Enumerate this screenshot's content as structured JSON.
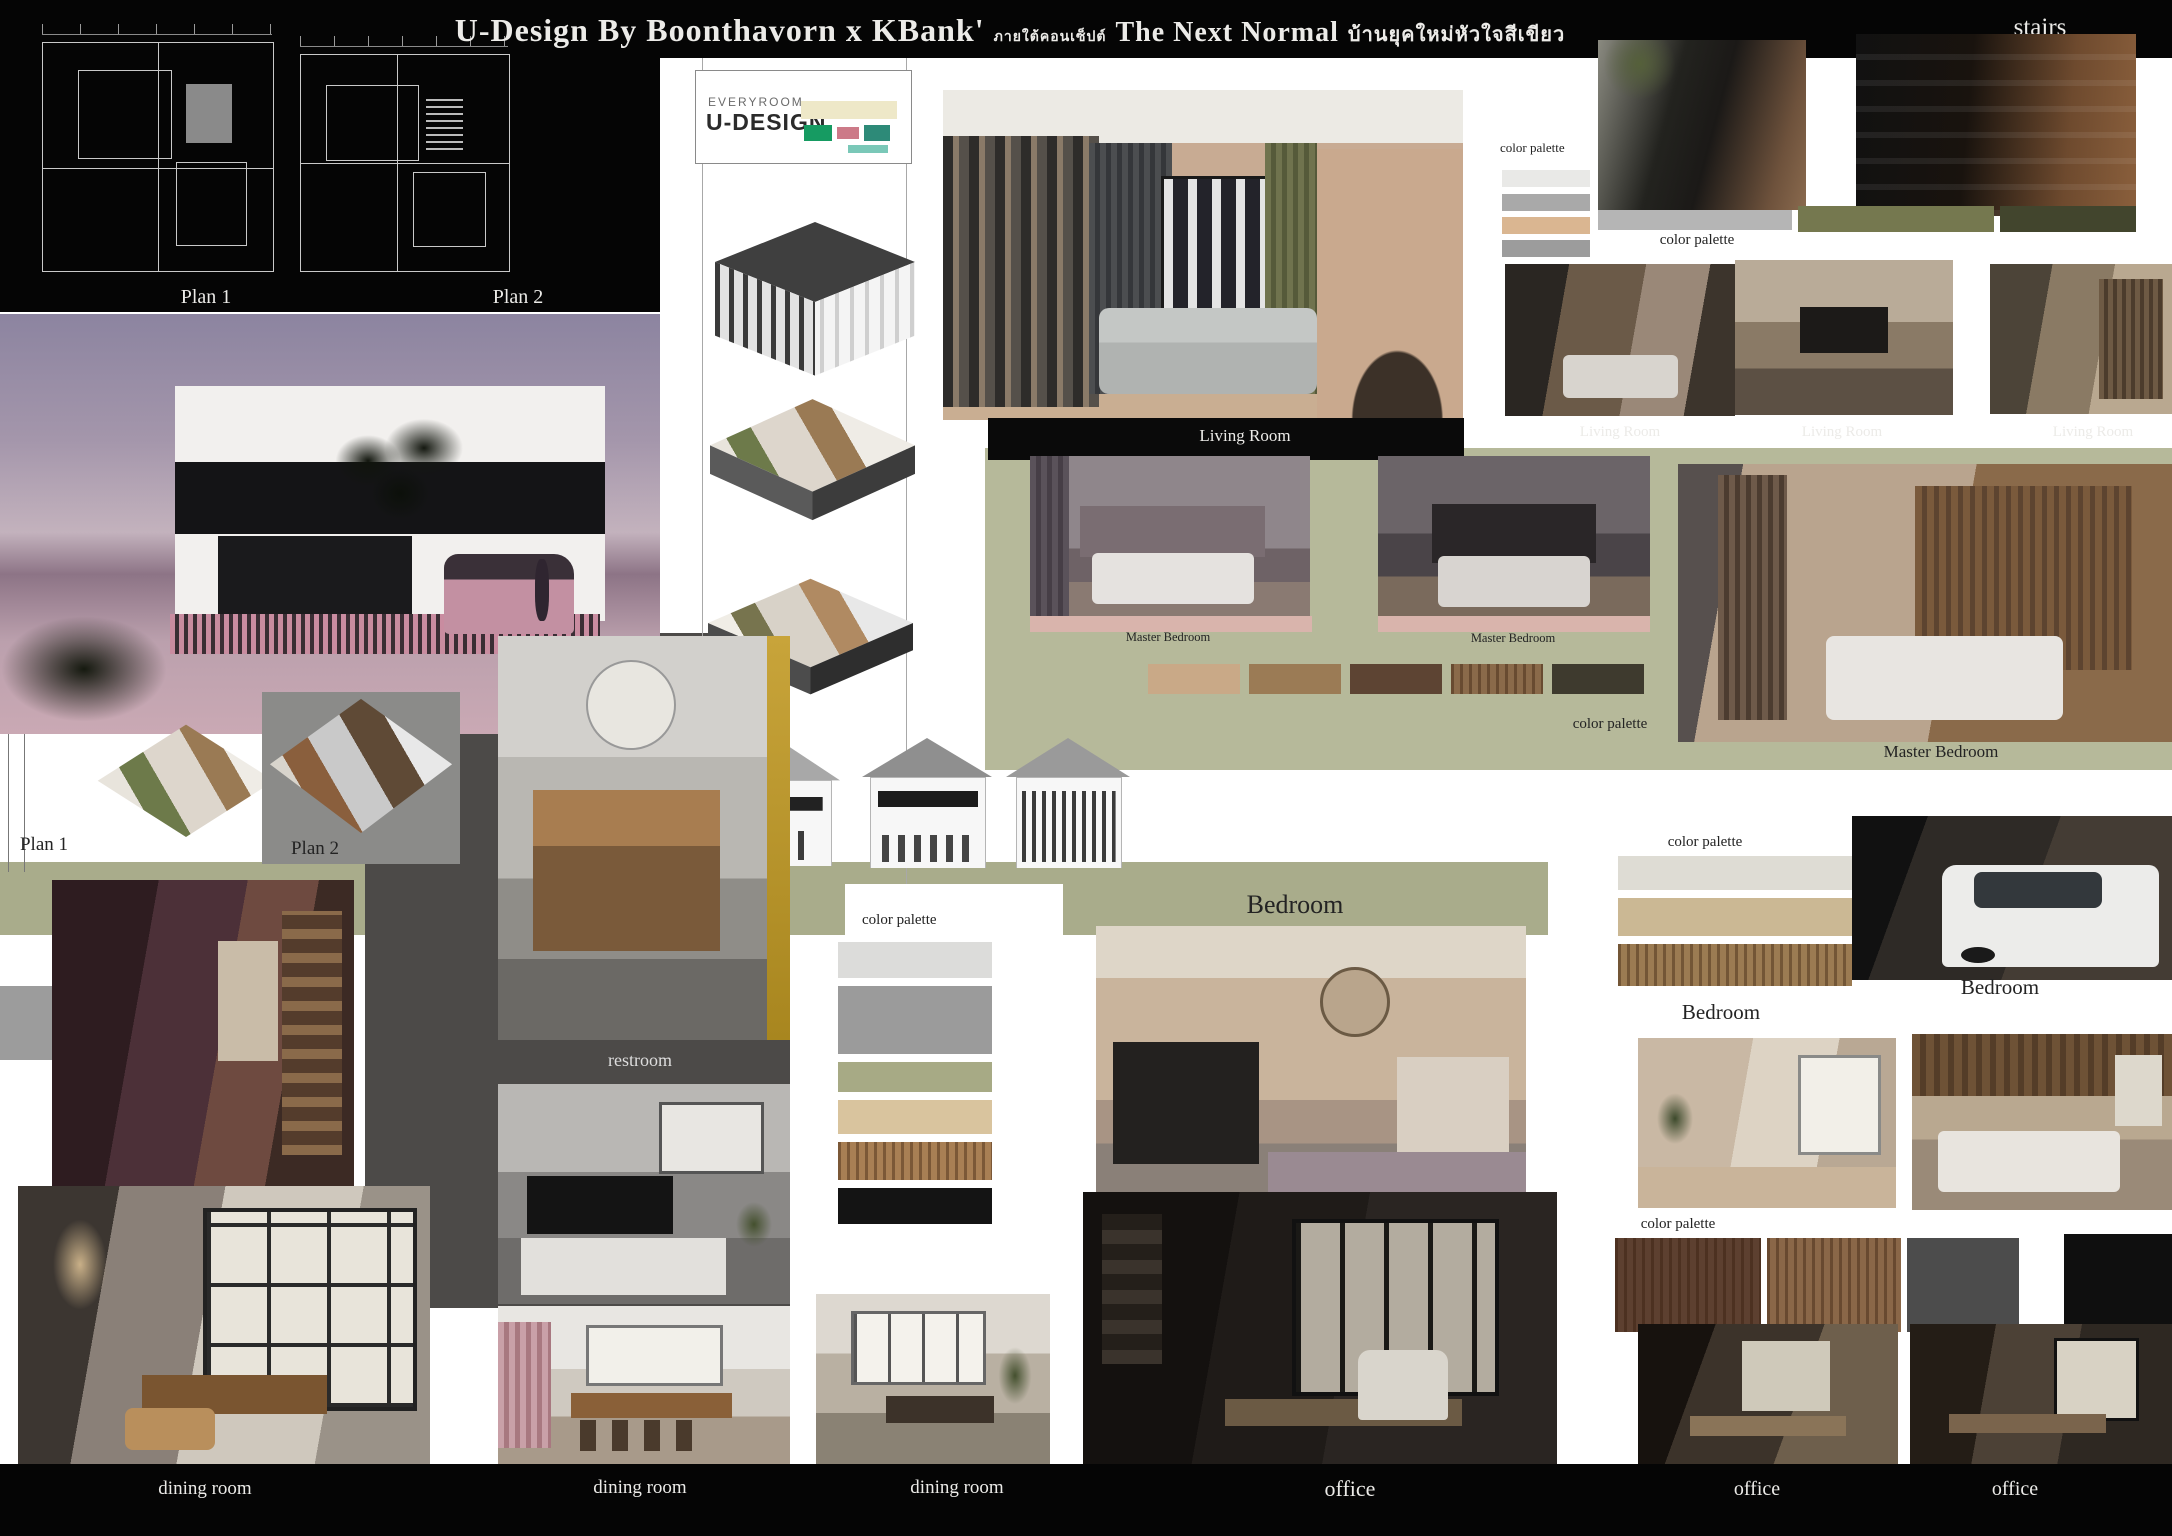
{
  "title": {
    "main": "U-Design By Boonthavorn x KBank'",
    "thai_prefix": "ภายใต้คอนเซ็ปต์",
    "concept": "The Next Normal",
    "thai_suffix": "บ้านยุคใหม่หัวใจสีเขียว"
  },
  "logo": {
    "top": "EVERYROOM",
    "bottom": "U-DESIGN"
  },
  "labels": {
    "stairs": "stairs",
    "plan_1": "Plan 1",
    "plan_2": "Plan 2",
    "color_palette": "color palette",
    "living_room": "Living Room",
    "master_bedroom": "Master Bedroom",
    "bedroom": "Bedroom",
    "restroom": "restroom",
    "dining_room": "dining  room",
    "office": "office"
  },
  "palettes": {
    "top_right_card": [
      "#e9e9e7",
      "#a9a9a9",
      "#dab691",
      "#9c9c9c"
    ],
    "stairs_row": [
      "#b5b5b5",
      "#75784f",
      "#42452d"
    ],
    "master_bedroom_row": [
      "#c9a987",
      "#9b7b55",
      "#5d4433",
      "#8a6a4a",
      "#3e3a2e"
    ],
    "center_column": [
      "#dcdcda",
      "#9b9b9b",
      "#a7aa85",
      "#d9c49e",
      "#a87f54",
      "#141414"
    ],
    "bedroom_right": [
      "#dedcd4",
      "#cbb894",
      "#9b7b52"
    ],
    "office_row": [
      "#5d4030",
      "#8a6748",
      "#4c4c4c",
      "#0f0f0f"
    ]
  },
  "accents": {
    "olive_band": "#a9ac8b",
    "olive_band_light": "#b6b99a",
    "pink_bar": "#d9b4ac",
    "panel_dark": "#4c4a48"
  }
}
